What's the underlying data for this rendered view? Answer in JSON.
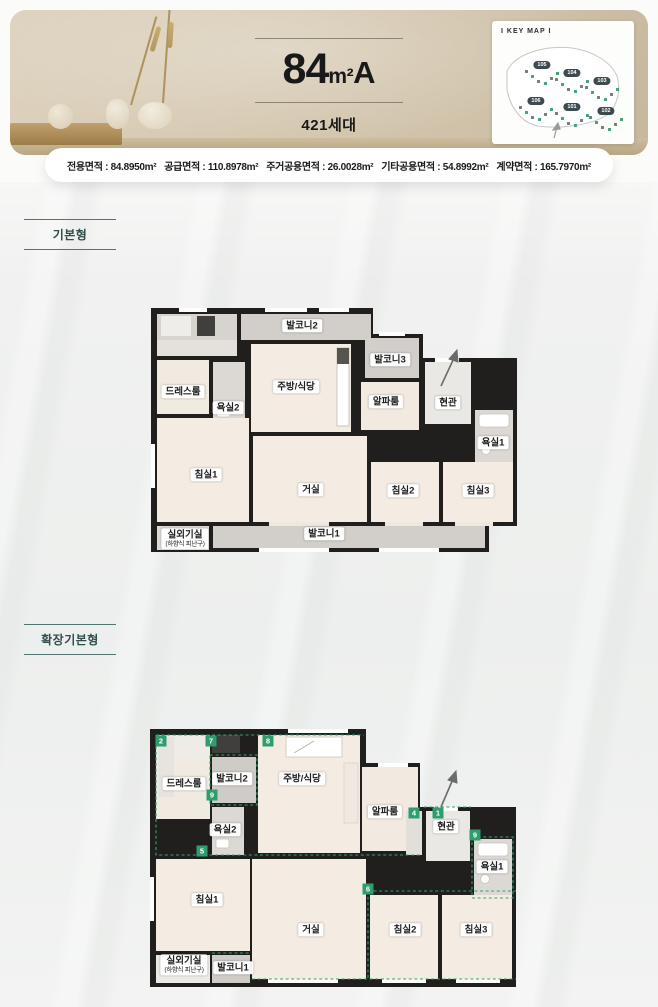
{
  "header": {
    "title": {
      "number": "84",
      "unit": "m²",
      "suffix": "A"
    },
    "units_label": "421세대",
    "keymap": {
      "title": "I KEY MAP I",
      "buildings": [
        {
          "id": "105",
          "x": 42,
          "y": 26
        },
        {
          "id": "104",
          "x": 72,
          "y": 34
        },
        {
          "id": "103",
          "x": 102,
          "y": 42
        },
        {
          "id": "106",
          "x": 36,
          "y": 62
        },
        {
          "id": "101",
          "x": 72,
          "y": 68
        },
        {
          "id": "102",
          "x": 106,
          "y": 72
        }
      ]
    }
  },
  "area_info": {
    "separator": " : ",
    "items": [
      {
        "label": "전용면적",
        "value": "84.8950m²"
      },
      {
        "label": "공급면적",
        "value": "110.8978m²"
      },
      {
        "label": "주거공용면적",
        "value": "26.0028m²"
      },
      {
        "label": "기타공용면적",
        "value": "54.8992m²"
      },
      {
        "label": "계약면적",
        "value": "165.7970m²"
      }
    ]
  },
  "sections": {
    "basic": "기본형",
    "extended": "확장기본형"
  },
  "plan_basic": {
    "rooms": [
      {
        "id": "balcony2",
        "name": "발코니2",
        "x": 163,
        "y": 22
      },
      {
        "id": "dressroom",
        "name": "드레스룸",
        "x": 44,
        "y": 88
      },
      {
        "id": "bath2",
        "name": "욕실2",
        "x": 89,
        "y": 104
      },
      {
        "id": "kitchen",
        "name": "주방/식당",
        "x": 157,
        "y": 83
      },
      {
        "id": "balcony3",
        "name": "발코니3",
        "x": 251,
        "y": 56
      },
      {
        "id": "alpharoom",
        "name": "알파룸",
        "x": 247,
        "y": 98
      },
      {
        "id": "entrance",
        "name": "현관",
        "x": 309,
        "y": 99
      },
      {
        "id": "bath1",
        "name": "욕실1",
        "x": 354,
        "y": 139
      },
      {
        "id": "bedroom1",
        "name": "침실1",
        "x": 67,
        "y": 171
      },
      {
        "id": "livingroom",
        "name": "거실",
        "x": 172,
        "y": 186
      },
      {
        "id": "bedroom2",
        "name": "침실2",
        "x": 264,
        "y": 187
      },
      {
        "id": "bedroom3",
        "name": "침실3",
        "x": 339,
        "y": 187
      },
      {
        "id": "balcony1",
        "name": "발코니1",
        "x": 185,
        "y": 230
      },
      {
        "id": "acroom",
        "name": "실외기실",
        "sub": "(하향식 피난구)",
        "x": 46,
        "y": 235
      }
    ]
  },
  "plan_extended": {
    "rooms": [
      {
        "id": "dressroom",
        "name": "드레스룸",
        "x": 46,
        "y": 57
      },
      {
        "id": "balcony2",
        "name": "발코니2",
        "x": 94,
        "y": 52
      },
      {
        "id": "kitchen",
        "name": "주방/식당",
        "x": 164,
        "y": 52
      },
      {
        "id": "alpharoom",
        "name": "알파룸",
        "x": 247,
        "y": 85
      },
      {
        "id": "entrance",
        "name": "현관",
        "x": 308,
        "y": 100
      },
      {
        "id": "bath2",
        "name": "욕실2",
        "x": 87,
        "y": 103
      },
      {
        "id": "bath1",
        "name": "욕실1",
        "x": 354,
        "y": 140
      },
      {
        "id": "bedroom1",
        "name": "침실1",
        "x": 69,
        "y": 173
      },
      {
        "id": "livingroom",
        "name": "거실",
        "x": 173,
        "y": 203
      },
      {
        "id": "bedroom2",
        "name": "침실2",
        "x": 267,
        "y": 203
      },
      {
        "id": "bedroom3",
        "name": "침실3",
        "x": 338,
        "y": 203
      },
      {
        "id": "acroom",
        "name": "실외기실",
        "sub": "(하향식 피난구)",
        "x": 46,
        "y": 238
      },
      {
        "id": "balcony1",
        "name": "발코니1",
        "x": 95,
        "y": 241
      }
    ],
    "badges": [
      {
        "num": "2",
        "x": 23,
        "y": 14
      },
      {
        "num": "7",
        "x": 73,
        "y": 14
      },
      {
        "num": "8",
        "x": 130,
        "y": 14
      },
      {
        "num": "9",
        "x": 74,
        "y": 68
      },
      {
        "num": "5",
        "x": 64,
        "y": 124
      },
      {
        "num": "4",
        "x": 276,
        "y": 86
      },
      {
        "num": "1",
        "x": 300,
        "y": 86
      },
      {
        "num": "9",
        "x": 337,
        "y": 108
      },
      {
        "num": "6",
        "x": 230,
        "y": 162
      }
    ]
  },
  "colors": {
    "accent_green": "#2f9e6e",
    "section_teal": "#2f4f4a",
    "wall": "#201f1d",
    "floor": "#f4ece3",
    "balcony": "#d2cfcb",
    "header_beige": "#d6c9b2"
  }
}
